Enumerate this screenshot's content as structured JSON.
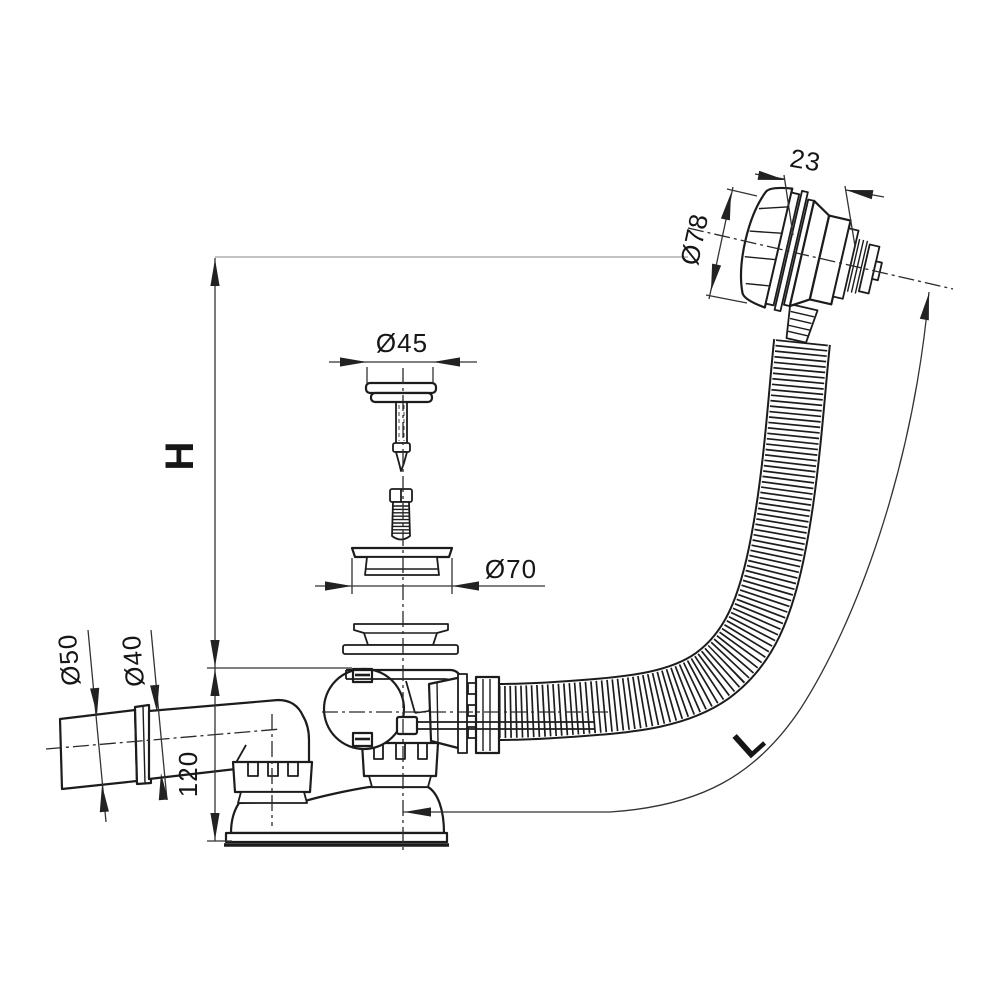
{
  "labels": {
    "overflow_cap_width": "23",
    "overflow_cap_diameter": "Ø78",
    "plug_diameter": "Ø45",
    "flange_diameter": "Ø70",
    "outlet_socket_diameter": "Ø50",
    "outlet_pipe_diameter": "Ø40",
    "base_height": "120",
    "overall_height": "H",
    "hose_length": "L"
  },
  "colors": {
    "background": "#ffffff",
    "drawing_line": "#1c1c1c",
    "dimension_line": "#333333",
    "extension_line": "#888888"
  }
}
